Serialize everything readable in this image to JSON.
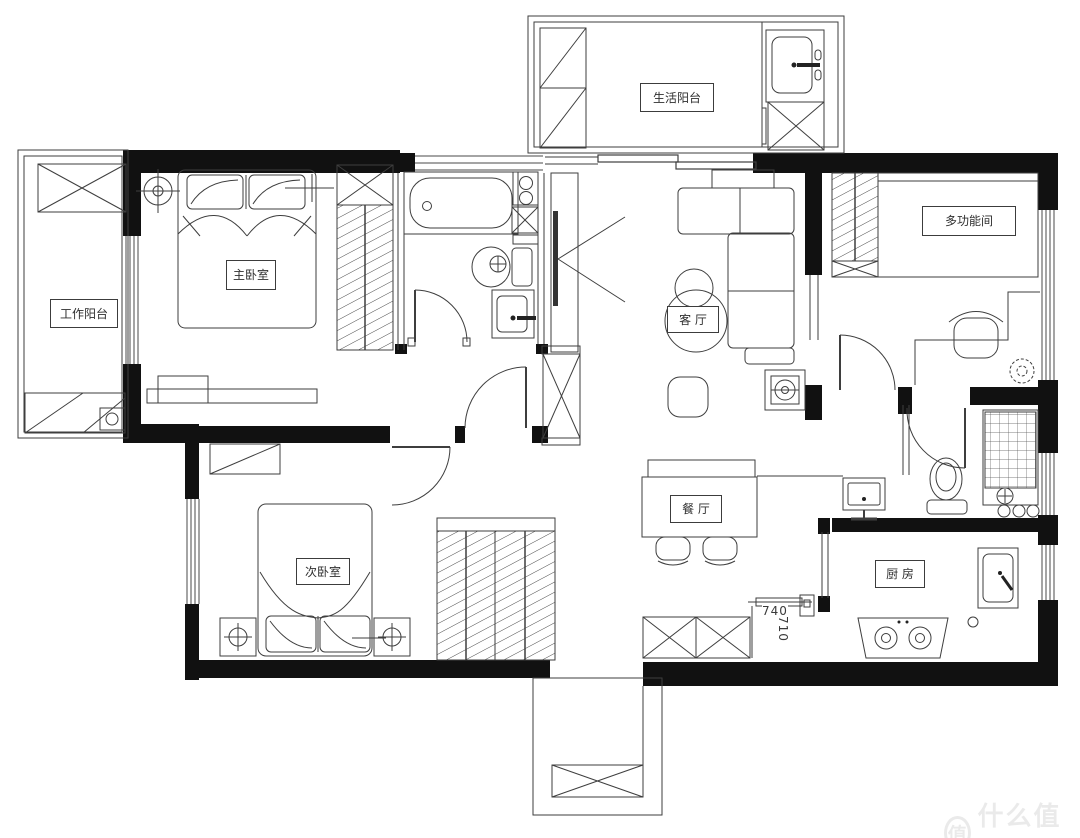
{
  "rooms": {
    "life_balcony": "生活阳台",
    "work_balcony": "工作阳台",
    "master_bedroom": "主卧室",
    "multi_function_room": "多功能间",
    "living_room": "客 厅",
    "dining_room": "餐 厅",
    "second_bedroom": "次卧室",
    "kitchen": "厨 房"
  },
  "dimensions": {
    "fridge_width": "740",
    "fridge_depth": "710"
  },
  "watermark": {
    "logo": "值",
    "text": "什么值得买"
  },
  "colors": {
    "background": "#ffffff",
    "wall": "#111111",
    "line": "#3e3e3e",
    "watermark": "#e8e8e8"
  }
}
